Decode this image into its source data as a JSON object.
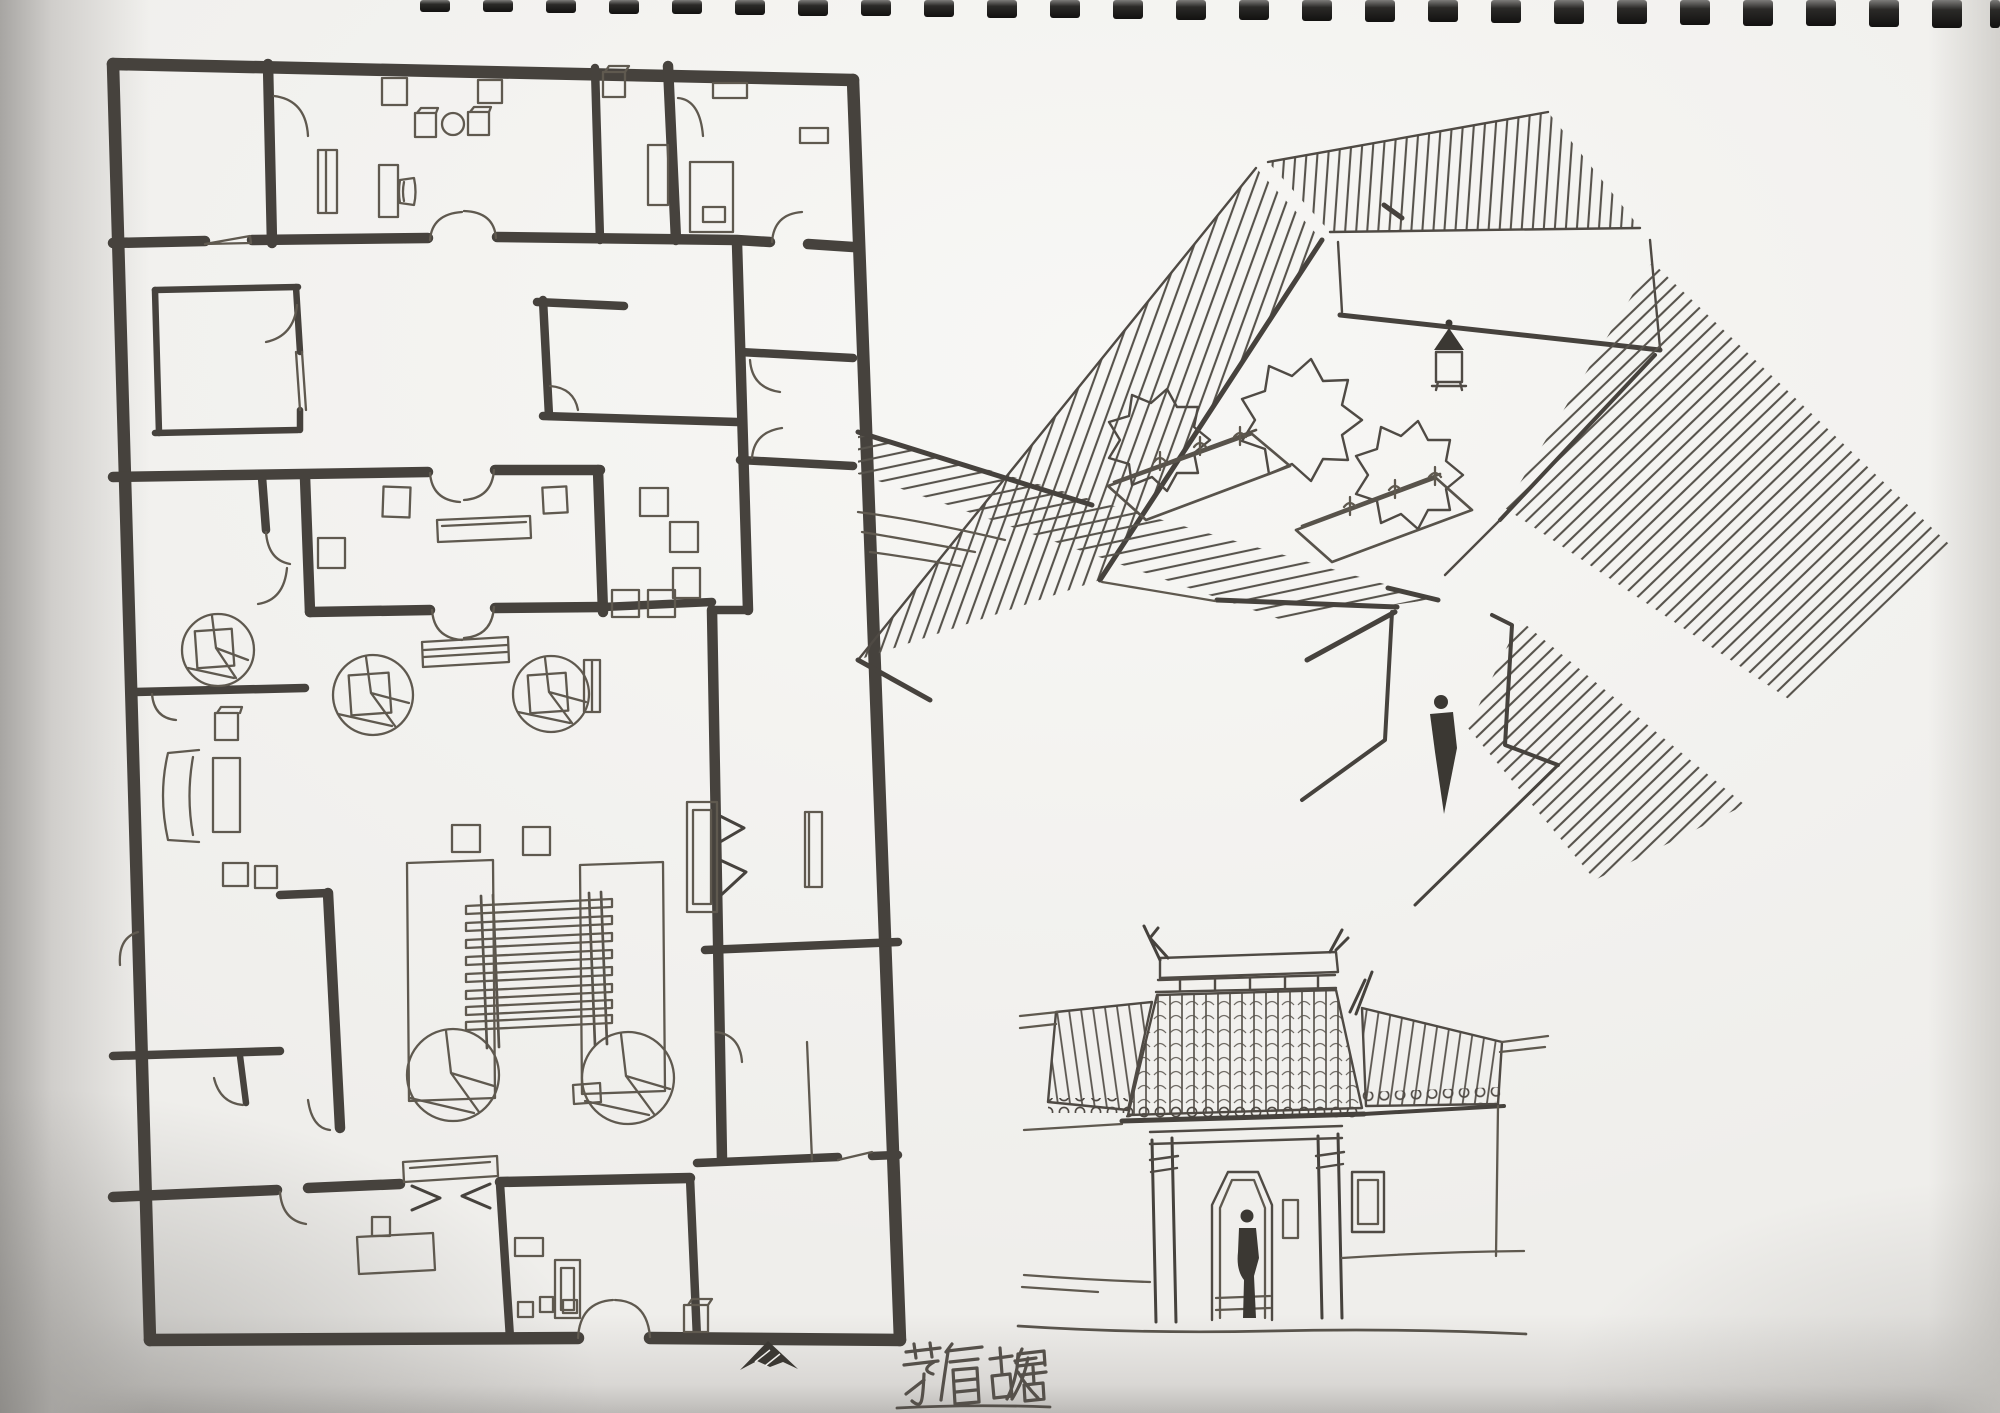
{
  "page": {
    "paper_color": "#efeeeb",
    "ink_color": "#46423d",
    "caption": {
      "text": "茅盾故居"
    },
    "drawings": {
      "floor_plan": {
        "label": "floor plan of courtyard residence"
      },
      "aerial_sketch": {
        "label": "bird's-eye sketch of inner courtyard"
      },
      "gate_elevation": {
        "label": "front gate elevation sketch"
      }
    },
    "north_indicator": {
      "label": "north arrow"
    },
    "binding": {
      "label": "spiral binding holes"
    }
  }
}
